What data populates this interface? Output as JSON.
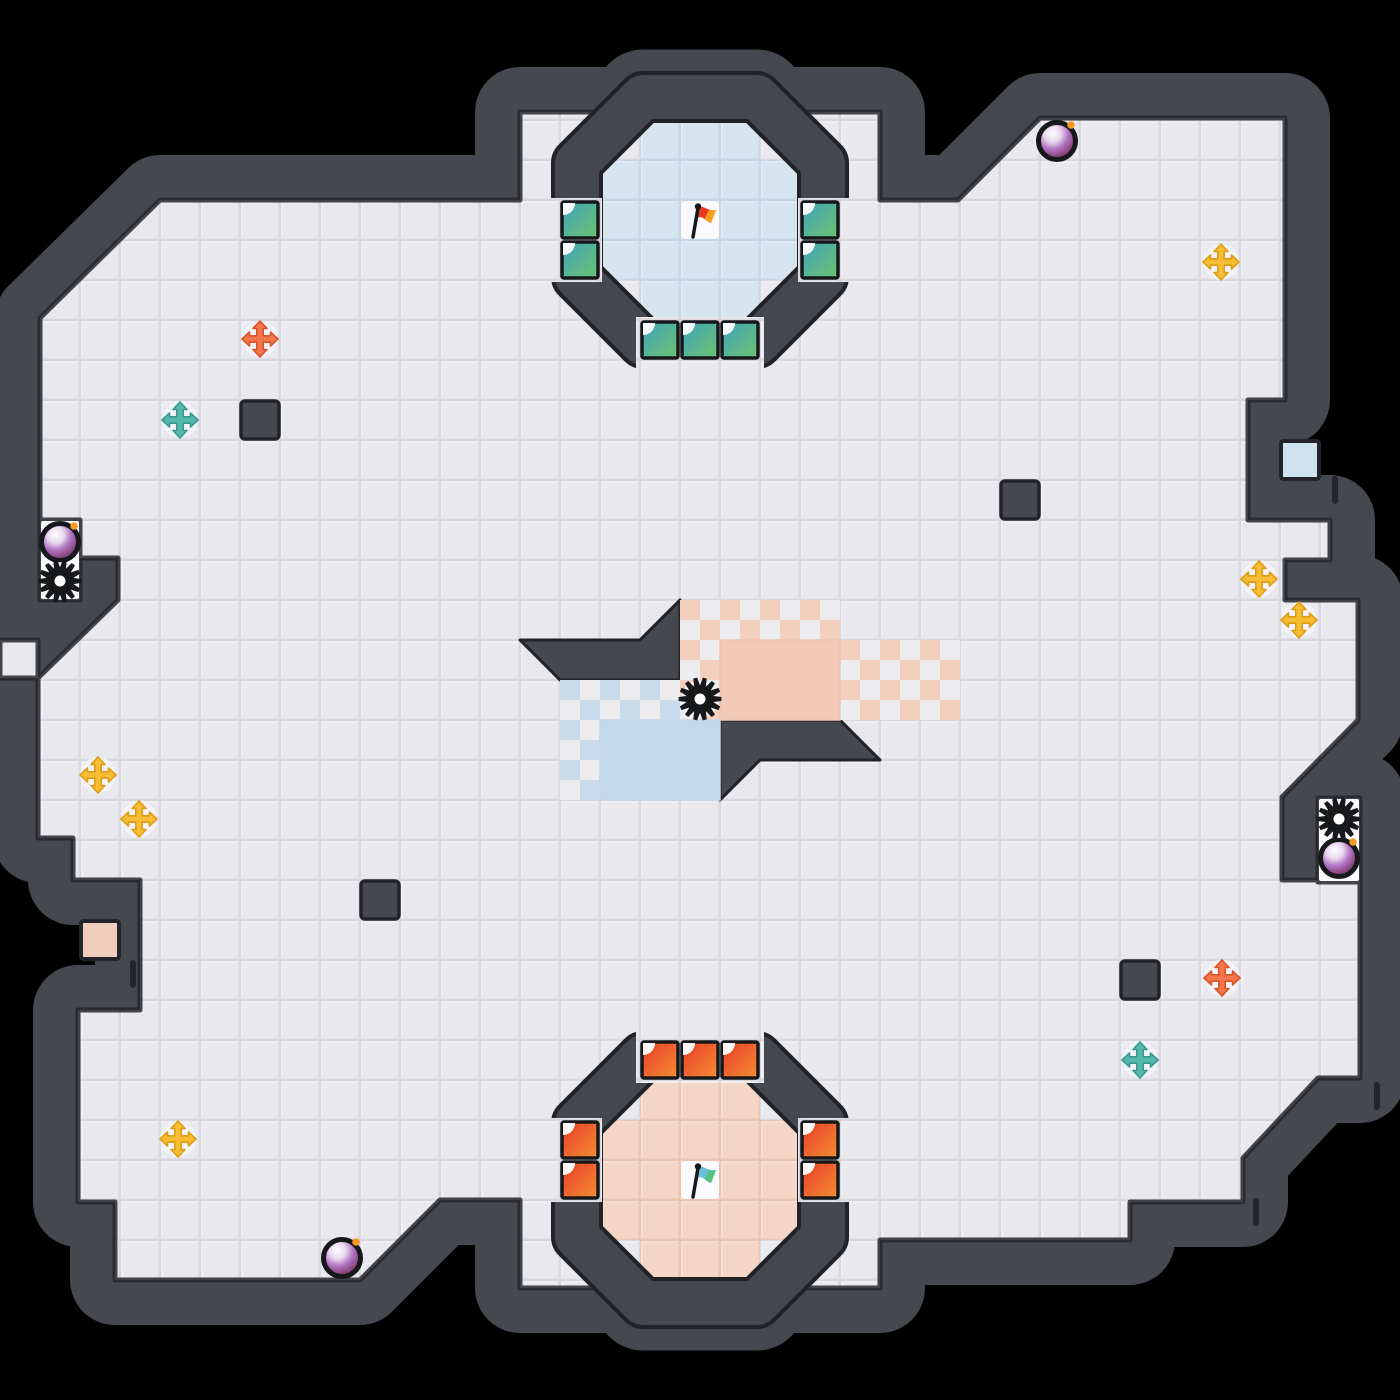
{
  "scene": {
    "type": "top-down tile game map (capture-the-flag style)",
    "background": "#000000"
  },
  "grid": {
    "tile_px": 40,
    "cols": 35,
    "rows": 35
  },
  "palette": {
    "wall": "#46484f",
    "wall_edge": "#24252a",
    "floor_base": "#e9e9ed",
    "floor_gap": "#d7d7dd",
    "floor_highlight": "#f4f4f7",
    "blue_floor": "#d6e4f0",
    "blue_gap": "#c6d6e7",
    "blue_highlight": "#e8f0f8",
    "pink_floor": "#f3d6c6",
    "pink_gap": "#e9c5b2",
    "pink_highlight": "#f9e8dc",
    "check_bg": "#ededf0",
    "check_pink": "#f3cfbe",
    "check_blue": "#c9dcee",
    "solid_pink": "#f2c9b6",
    "solid_blue": "#c3d9ec",
    "boost_green_a": "#3fa3bd",
    "boost_green_b": "#6cc46d",
    "boost_red_a": "#e93a26",
    "boost_red_b": "#f58f35",
    "tile_border": "#17181c",
    "white_cell": "#fafafc",
    "bomb_shine": "#ffffff",
    "bomb_mid": "#b277c4",
    "bomb_deep": "#8e4a86",
    "bomb_dark": "#5f2c4e",
    "bomb_outline": "#17181b",
    "bomb_spark": "#f59a23",
    "spike": "#17181a",
    "powerup_bg": "#f4f5f8"
  },
  "powerup_colors": {
    "orange": {
      "fill": "#f4764a",
      "stroke": "#d85427"
    },
    "yellow": {
      "fill": "#f6bd35",
      "stroke": "#dd9c14"
    },
    "teal": {
      "fill": "#55b9ab",
      "stroke": "#38998f"
    }
  },
  "bases": {
    "top": {
      "team": "blue",
      "flag": {
        "name": "red-flag",
        "color_main": "#e8381f",
        "color_accent": "#f6a21c",
        "x": 700,
        "y": 220
      },
      "flag_tile": [
        680,
        200
      ],
      "floor_rects": [
        [
          640,
          120,
          120,
          40
        ],
        [
          600,
          160,
          200,
          120
        ],
        [
          640,
          280,
          120,
          40
        ]
      ],
      "boost_color": "green",
      "boost_tiles": [
        [
          560,
          200
        ],
        [
          560,
          240
        ],
        [
          800,
          200
        ],
        [
          800,
          240
        ],
        [
          640,
          320
        ],
        [
          680,
          320
        ],
        [
          720,
          320
        ]
      ]
    },
    "bottom": {
      "team": "red",
      "flag": {
        "name": "teal-flag",
        "color_main": "#66bfdd",
        "color_accent": "#55c17e",
        "x": 700,
        "y": 1180
      },
      "flag_tile": [
        680,
        1160
      ],
      "floor_rects": [
        [
          640,
          1080,
          120,
          40
        ],
        [
          600,
          1120,
          200,
          120
        ],
        [
          640,
          1240,
          120,
          40
        ]
      ],
      "boost_color": "red",
      "boost_tiles": [
        [
          640,
          1040
        ],
        [
          680,
          1040
        ],
        [
          720,
          1040
        ],
        [
          560,
          1120
        ],
        [
          560,
          1160
        ],
        [
          800,
          1120
        ],
        [
          800,
          1160
        ]
      ]
    }
  },
  "center_zones": {
    "checker_pink": [
      [
        680,
        600,
        160,
        40
      ],
      [
        680,
        640,
        40,
        80
      ],
      [
        840,
        640,
        120,
        80
      ]
    ],
    "solid_pink": [
      [
        720,
        640,
        120,
        80
      ]
    ],
    "checker_blue": [
      [
        560,
        680,
        120,
        40
      ],
      [
        560,
        720,
        40,
        80
      ]
    ],
    "solid_blue": [
      [
        600,
        720,
        120,
        80
      ]
    ]
  },
  "white_cells": [
    [
      40,
      520,
      40,
      80
    ],
    [
      1318,
      798,
      42,
      84
    ],
    [
      680,
      200,
      40,
      40
    ],
    [
      680,
      1160,
      40,
      40
    ]
  ],
  "blocks": [
    [
      240,
      400
    ],
    [
      1000,
      480
    ],
    [
      360,
      880
    ],
    [
      1120,
      960
    ]
  ],
  "embedded_tiles": [
    {
      "name": "blue-gate-tile",
      "color": "#cfe2f0",
      "x": 1280,
      "y": 440
    },
    {
      "name": "pink-gate-tile",
      "color": "#f1cebc",
      "x": 80,
      "y": 920
    }
  ],
  "wall_ticks": [
    [
      1332,
      476
    ],
    [
      130,
      960
    ],
    [
      1253,
      1198
    ],
    [
      1374,
      1082
    ]
  ],
  "bombs": [
    [
      1057,
      141
    ],
    [
      60,
      542
    ],
    [
      1339,
      858
    ],
    [
      342,
      1258
    ]
  ],
  "spikes": [
    [
      700,
      699
    ],
    [
      60,
      581
    ],
    [
      1339,
      819
    ]
  ],
  "powerups": [
    {
      "color": "orange",
      "x": 260,
      "y": 339
    },
    {
      "color": "teal",
      "x": 180,
      "y": 420
    },
    {
      "color": "yellow",
      "x": 1221,
      "y": 262
    },
    {
      "color": "yellow",
      "x": 1259,
      "y": 579
    },
    {
      "color": "yellow",
      "x": 1299,
      "y": 620
    },
    {
      "color": "yellow",
      "x": 98,
      "y": 775
    },
    {
      "color": "yellow",
      "x": 139,
      "y": 819
    },
    {
      "color": "orange",
      "x": 1222,
      "y": 978
    },
    {
      "color": "teal",
      "x": 1140,
      "y": 1060
    },
    {
      "color": "yellow",
      "x": 178,
      "y": 1139
    }
  ]
}
